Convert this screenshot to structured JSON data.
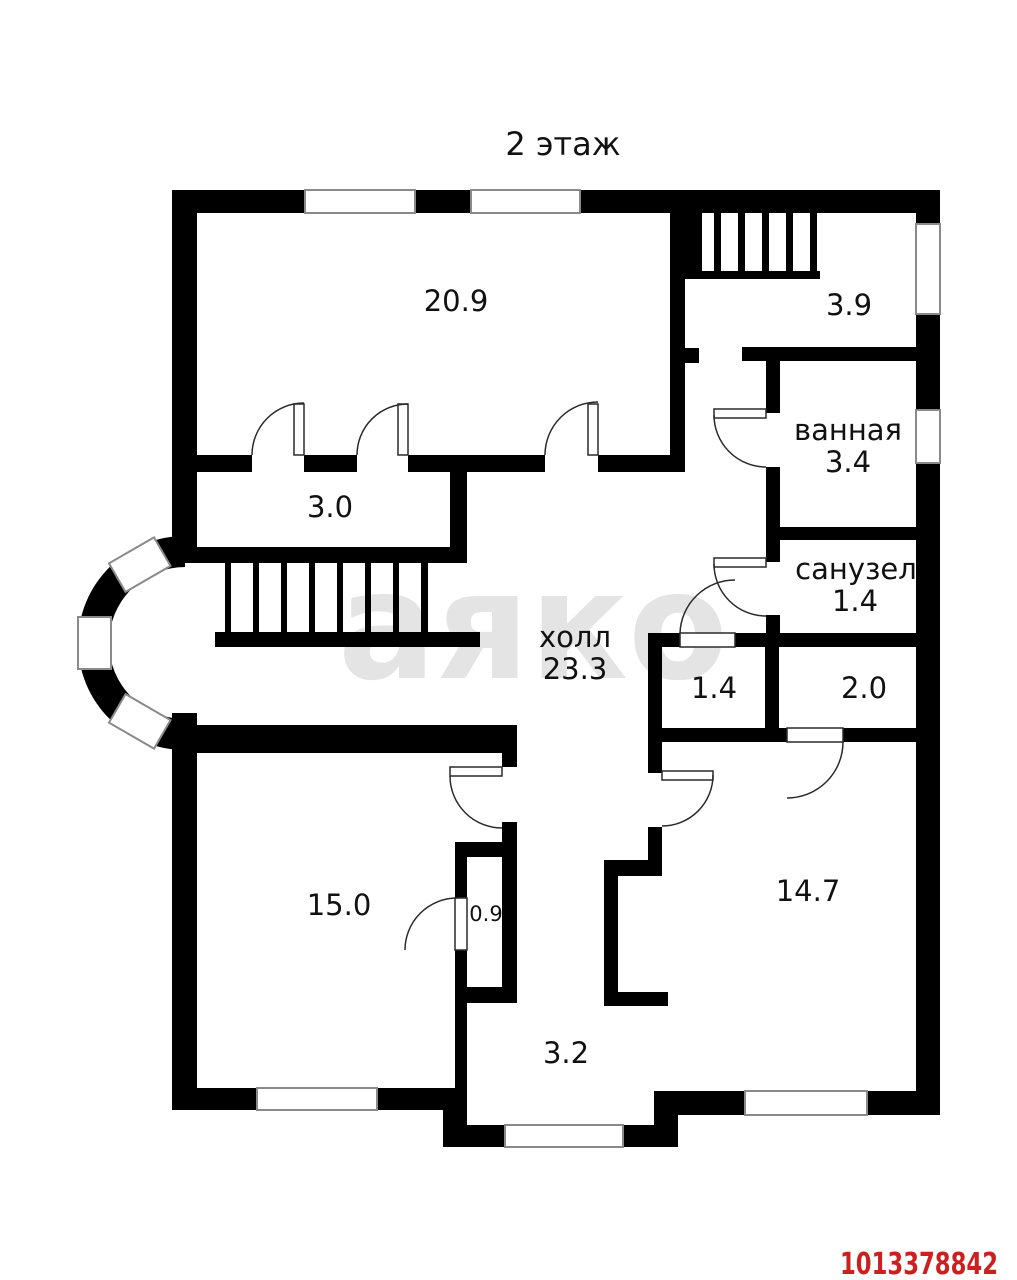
{
  "title": "2 этаж",
  "watermark_text": "аяко",
  "listing_id": "1013378842",
  "colors": {
    "wall": "#000000",
    "window_stroke": "#8a8a8a",
    "watermark": "#e4e4e4",
    "listing_id_red": "#cc2020"
  },
  "rooms": [
    {
      "id": "room-20-9",
      "name": "",
      "area": "20.9"
    },
    {
      "id": "stair-room-3-9",
      "name": "",
      "area": "3.9"
    },
    {
      "id": "bathroom",
      "name": "ванная",
      "area": "3.4"
    },
    {
      "id": "wc",
      "name": "санузел",
      "area": "1.4"
    },
    {
      "id": "room-3-0",
      "name": "",
      "area": "3.0"
    },
    {
      "id": "hall",
      "name": "холл",
      "area": "23.3"
    },
    {
      "id": "storage-1-4",
      "name": "",
      "area": "1.4"
    },
    {
      "id": "storage-2-0",
      "name": "",
      "area": "2.0"
    },
    {
      "id": "room-15-0",
      "name": "",
      "area": "15.0"
    },
    {
      "id": "closet-0-9",
      "name": "",
      "area": "0.9"
    },
    {
      "id": "room-14-7",
      "name": "",
      "area": "14.7"
    },
    {
      "id": "corridor-3-2",
      "name": "",
      "area": "3.2"
    }
  ]
}
